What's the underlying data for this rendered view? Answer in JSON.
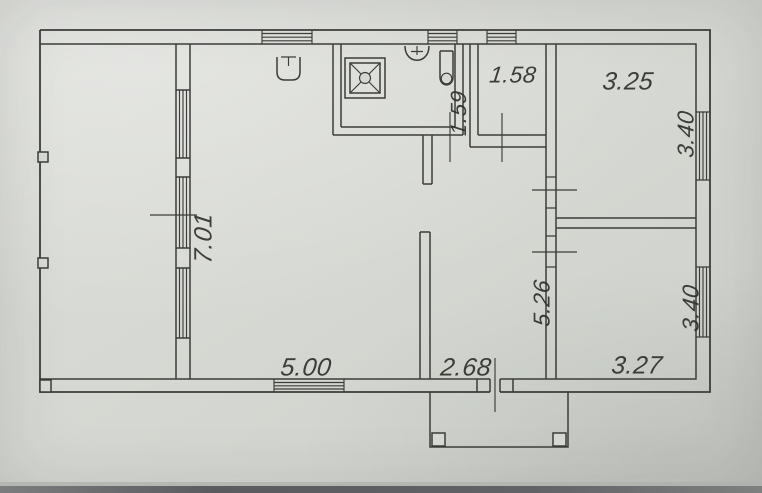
{
  "plan": {
    "type": "floor-plan-scan",
    "colors": {
      "paper": "#d6d8d3",
      "ink": "#3c3d3a",
      "text": "#30312d"
    },
    "labels": {
      "veranda_length": "7.01",
      "living_width": "5.00",
      "hall_width": "2.68",
      "bath_depth": "1.59",
      "storage_width": "1.58",
      "room_top_width": "3.25",
      "room_top_depth": "3.40",
      "hall_length": "5.26",
      "room_bottom_depth": "3.40",
      "room_bottom_width": "3.27"
    },
    "fixtures": [
      "shower-tray",
      "wash-basin",
      "water-heater",
      "kitchen-sink",
      "porch-posts"
    ]
  }
}
